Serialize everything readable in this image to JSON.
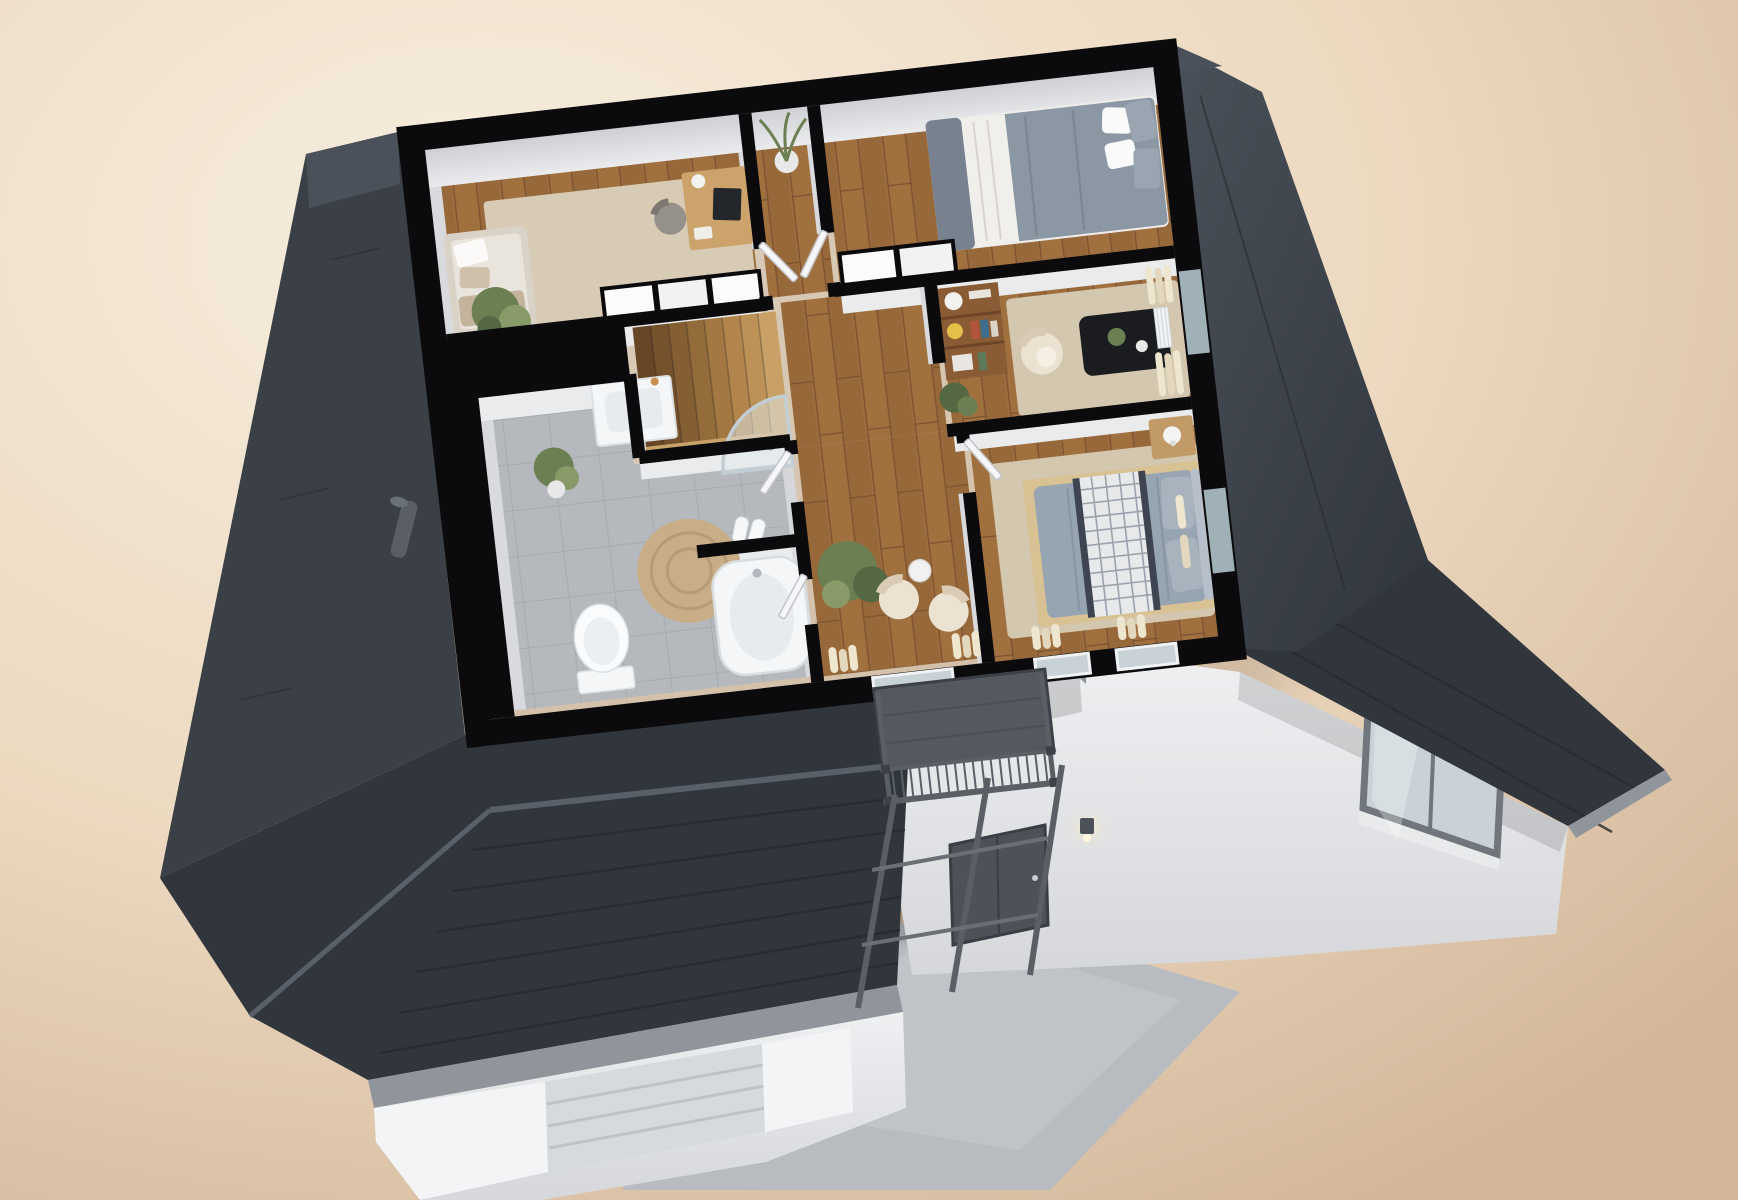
{
  "scene": {
    "type": "3d-floor-plan-render",
    "view": "isometric-cutaway-top",
    "floor": "upper-floor-of-house",
    "rooms": [
      {
        "name": "home-office",
        "items": [
          "daybed-sofa",
          "throw-pillows",
          "potted-plant",
          "area-rug",
          "desk",
          "desk-monitor",
          "desk-chair",
          "wardrobe-closets"
        ]
      },
      {
        "name": "bedroom-1",
        "items": [
          "double-bed",
          "gray-duvet",
          "white-quilt",
          "pillows",
          "wardrobe-closets"
        ]
      },
      {
        "name": "living-room",
        "items": [
          "bookshelf",
          "books",
          "yellow-vase",
          "white-armchair",
          "black-coffee-table",
          "table-plant",
          "beige-rug",
          "cream-curtains",
          "radiator",
          "monstera-plant"
        ]
      },
      {
        "name": "bedroom-2",
        "items": [
          "double-bed",
          "plaid-throw",
          "gray-duvet",
          "pillows",
          "nightstand",
          "table-lamp",
          "beige-rug",
          "cream-curtains"
        ]
      },
      {
        "name": "bathroom",
        "items": [
          "vanity-sink",
          "potted-plant",
          "round-jute-rug",
          "slippers",
          "curved-glass-shower",
          "toilet",
          "bathtub",
          "partition-wall"
        ]
      },
      {
        "name": "hallway",
        "items": [
          "staircase",
          "open-doors",
          "grass-plant",
          "wood-floor"
        ]
      },
      {
        "name": "lounge-corner",
        "items": [
          "armchair-left",
          "armchair-right",
          "large-potted-plant",
          "cream-curtains",
          "balcony-glass-door"
        ]
      },
      {
        "name": "balcony",
        "items": [
          "metal-railing",
          "balusters",
          "corner-posts"
        ]
      }
    ],
    "exterior": [
      "charcoal-left-roof",
      "gable-end",
      "vent-pipe",
      "large-hip-roof",
      "shingle-lines",
      "eave-gutter",
      "garage-door",
      "white-facade",
      "entrance-door",
      "wall-lamp",
      "support-posts",
      "concrete-terrace",
      "terrace-light",
      "east-roof-band",
      "dormer-roof",
      "facade-window"
    ]
  },
  "colors": {
    "bg_light": "#f7eedf",
    "bg_mid": "#ecd9c0",
    "bg_dark": "#d3b79a",
    "wall_black": "#0b0b0d",
    "wall_face": "#eaebed",
    "wall_face2": "#d9dadd",
    "wall_face3": "#cfd0d4",
    "roof_dark": "#31363d",
    "roof_mid": "#3b4047",
    "roof_light": "#4b515a",
    "roof_edge": "#8f959b",
    "ridge": "#5a6069",
    "facade": "#eff0f2",
    "facade_shadow": "#d5d7da",
    "wood_base": "#a0703f",
    "wood_stripe": "#8f6136",
    "wood_seam": "#7b5230",
    "rug_office": "#d8cbb6",
    "rug_beige": "#d3c7af",
    "rug_jute": "#c8ad87",
    "tile": "#b5b8bc",
    "tile_line": "#a7abaf",
    "glass": "#c9d3d7",
    "frame": "#71767c",
    "steel": "#5a5f66",
    "steel_dark": "#3d4147",
    "terrace": "#b8bcc1",
    "terrace_light": "#c9ccd0",
    "porcelain": "#f4f6f7",
    "white": "#fafbfc",
    "basin": "#e7ebee",
    "cream": "#efe6cf",
    "chair_cream": "#ece2d2",
    "chair_shadow": "#d9cbb6",
    "duvet": "#8c97a4",
    "duvet2": "#97a4b2",
    "mattress": "#efedea",
    "throw_gray": "#77828e",
    "plaid": "#e7e9eb",
    "plaid_dark": "#3e4450",
    "bedframe": "#d8c193",
    "nightstand": "#c19a67",
    "shelf": "#8a5c36",
    "shelf_dark": "#6e4527",
    "vase_yellow": "#e5c048",
    "table_black": "#1a1c20",
    "plant": "#6b7f52",
    "plant_dark": "#556844",
    "plant_light": "#879a68",
    "pot": "#e8e8e8",
    "door_white": "#f6f6f8",
    "door_edge": "#c2c4c8",
    "step1": "#c9a167",
    "step8": "#674525",
    "lamp_glow": "#ffeec4"
  }
}
